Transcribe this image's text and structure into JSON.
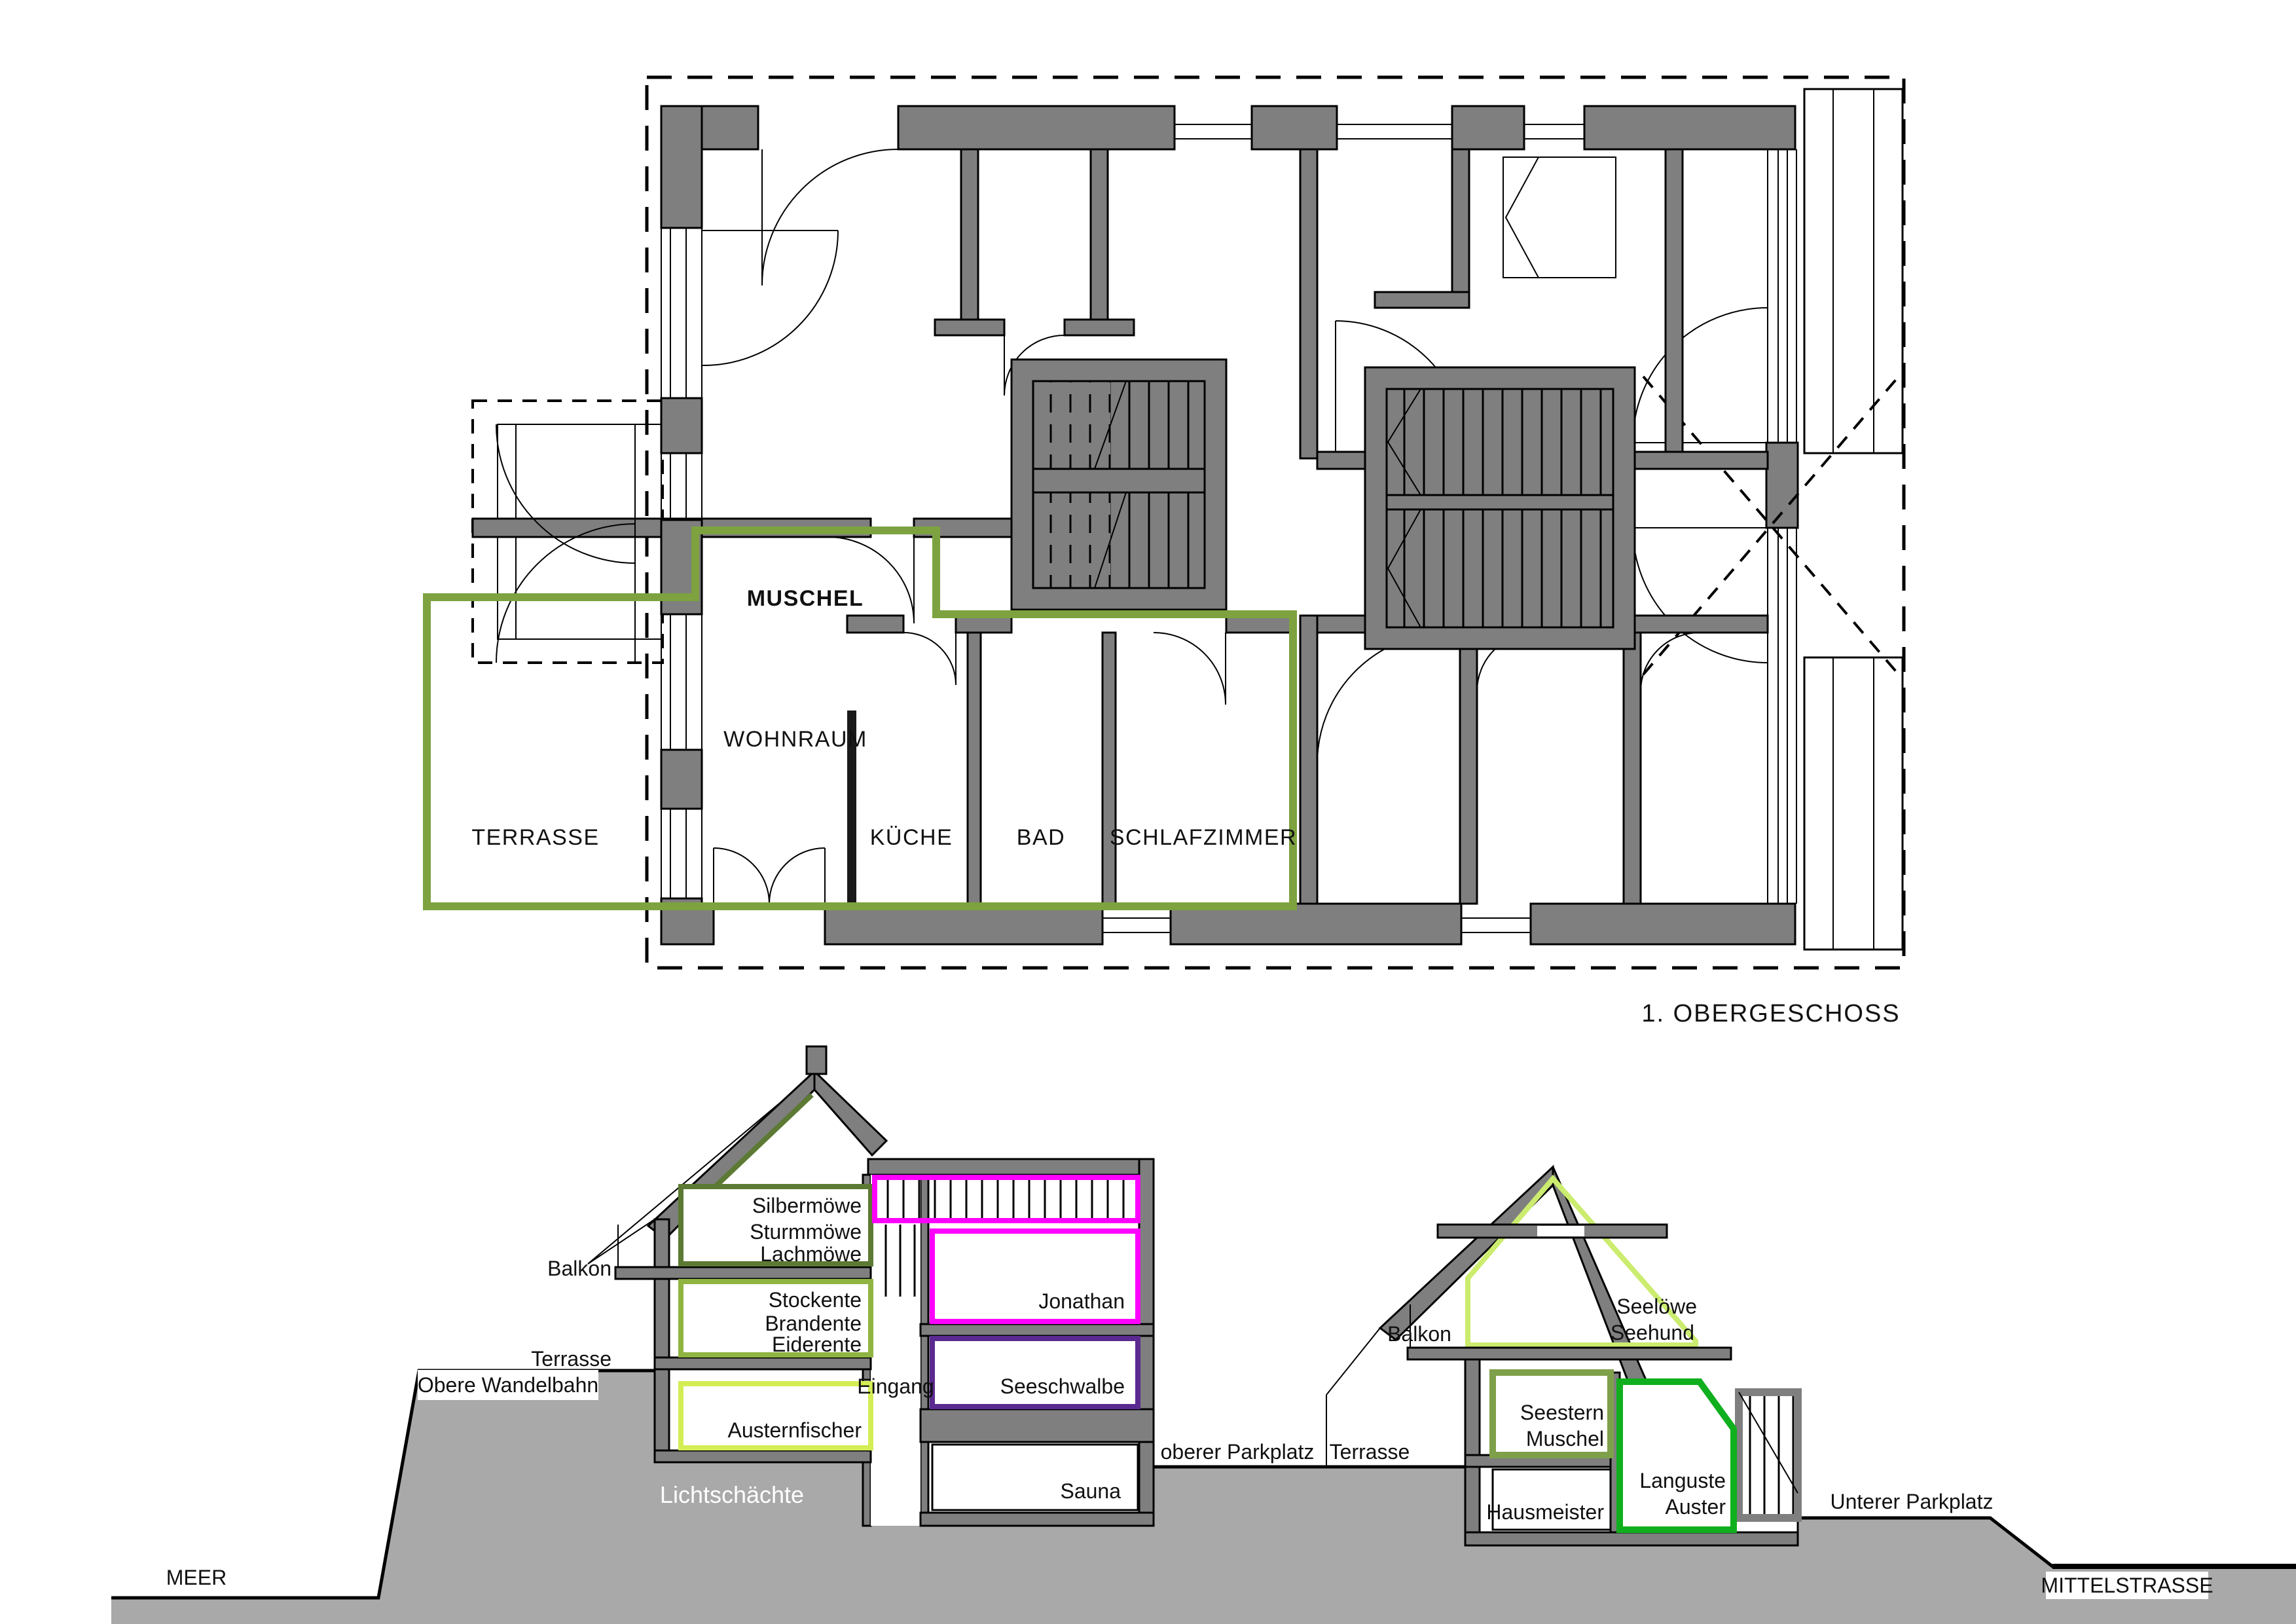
{
  "plan": {
    "apartment": "MUSCHEL",
    "wohnraum": "WOHNRAUM",
    "terrasse": "TERRASSE",
    "kueche": "KÜCHE",
    "bad": "BAD",
    "schlafzimmer": "SCHLAFZIMMER",
    "caption": "1. OBERGESCHOSS"
  },
  "left_building": {
    "balkon": "Balkon",
    "terrasse": "Terrasse",
    "top_rooms": [
      "Silbermöwe",
      "Sturmmöwe",
      "Lachmöwe"
    ],
    "mid_rooms": [
      "Stockente",
      "Brandente",
      "Eiderente"
    ],
    "basement_room": "Austernfischer",
    "promenade": "Obere Wandelbahn",
    "entrance": "Eingang",
    "jonathan": "Jonathan",
    "seeschwalbe": "Seeschwalbe",
    "sauna": "Sauna",
    "light_wells": "Lichtschächte"
  },
  "right_building": {
    "balkon": "Balkon",
    "terrasse": "Terrasse",
    "attic_rooms": [
      "Seelöwe",
      "Seehund"
    ],
    "mid_rooms": [
      "Seestern",
      "Muschel"
    ],
    "caretaker": "Hausmeister",
    "basement_rooms": [
      "Languste",
      "Auster"
    ]
  },
  "site": {
    "meer": "MEER",
    "upper_parking": "oberer Parkplatz",
    "lower_parking": "Unterer Parkplatz",
    "street": "MITTELSTRASSE"
  },
  "colors": {
    "wall_gray": "#7f7f7f",
    "terrain_gray": "#a9a9a9",
    "plan_accent_green": "#7da23f",
    "dark_olive": "#5c7a33",
    "mid_green": "#8fb441",
    "chartreuse": "#d3ee55",
    "light_chartreuse": "#cbec6e",
    "olive_green": "#7fa04a",
    "magenta": "#ff00ff",
    "violet": "#5b2a91",
    "bright_green": "#0faf1e"
  }
}
